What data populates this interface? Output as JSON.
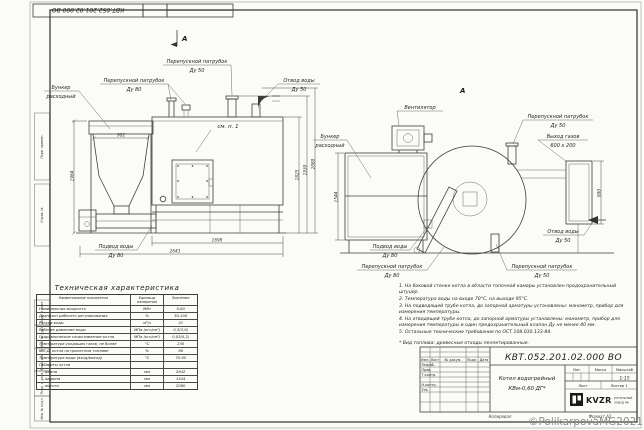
{
  "sheet": {
    "corner_stamp": "КВТ.052.201.02.000  ВО",
    "watermark": "©PolikarpovaMG2021"
  },
  "margin_fields": [
    "Перв. примен.",
    "Справ. №",
    "Подп. и дата",
    "Инв. № дубл.",
    "Взам. инв. №",
    "Подп. и дата",
    "Инв. № подл."
  ],
  "left_view": {
    "section_label": "А",
    "see_note": "см. п. 1",
    "labels": {
      "bunker": [
        "Бункер",
        "расходный"
      ],
      "bypass80": [
        "Перепускной патрубок",
        "Ду 80"
      ],
      "bypass50": [
        "Перепускной патрубок",
        "Ду 50"
      ],
      "outlet50": [
        "Отвод воды",
        "Ду 50"
      ],
      "inlet80": [
        "Подвод воды",
        "Ду 80"
      ]
    },
    "dims": {
      "top": "902",
      "left": "1964",
      "h1": "1825",
      "h2": "1930",
      "h3": "2080",
      "screw": "1698",
      "total": "2643"
    }
  },
  "right_view": {
    "view_label": "А",
    "labels": {
      "fan": "Вентилятор",
      "bunker": [
        "Бункер",
        "расходный"
      ],
      "bypass50_top": [
        "Перепускной патрубок",
        "Ду 50"
      ],
      "gas_out": [
        "Выход газов",
        "600 х 200"
      ],
      "outlet50": [
        "Отвод воды",
        "Ду 50"
      ],
      "inlet80": [
        "Подвод воды",
        "Ду 80"
      ],
      "bypass80": [
        "Перепускной патрубок",
        "Ду 80"
      ],
      "bypass50_bottom": [
        "Перепускной патрубок",
        "Ду 50"
      ]
    },
    "dims": {
      "bunker_h": "1544",
      "gas_h": "600"
    }
  },
  "table": {
    "title": "Техническая характеристика",
    "headers": [
      "Наименование показателя",
      "Единицы измерения",
      "Значение"
    ],
    "rows": [
      [
        "Номинальная мощность",
        "МВт",
        "0,60"
      ],
      [
        "Диапазон рабочего регулирования",
        "%",
        "30-100"
      ],
      [
        "Расход воды",
        "м³/ч",
        "21"
      ],
      [
        "Рабочее давление воды",
        "МПа (кгс/см²)",
        "0,3(3,0)"
      ],
      [
        "Гидравлическое сопротивление котла",
        "МПа (кгс/см²)",
        "0,02(0,2)"
      ],
      [
        "Температура уходящих газов, не более",
        "°С",
        "230"
      ],
      [
        "К.П.Д. котла на проектном топливе",
        "%",
        "80"
      ],
      [
        "Температура воды (вход/выход)",
        "°С",
        "70-95"
      ],
      [
        "Габариты котла",
        "",
        ""
      ],
      [
        "   - длина",
        "мм",
        "2642"
      ],
      [
        "   - ширина",
        "мм",
        "1544"
      ],
      [
        "   - высота",
        "мм",
        "2080"
      ]
    ]
  },
  "notes": {
    "items": [
      "1. На боковой стенке котла в области топочной камеры установлен предохранительный штуцер.",
      "2. Температура воды на входе 70°С, на выходе 95°С.",
      "3. На подводящей трубе котла, до запорной арматуры установлены: манометр, прибор для измерения температуры.",
      "4. На отводящей трубе котла, до запорной арматуры установлены: манометр, прибор для измерения температуры и один предохранительный клапан Ду не менее 40 мм.",
      "5. Остальные технические требования по ОСТ 108.030.133-84."
    ],
    "footnote": "* Вид топлива: древесные отходы пеллетированные."
  },
  "title_block": {
    "doc_number": "КВТ.052.201.02.000  ВО",
    "name_line1": "Котел водогрейный",
    "name_line2": "КВм-0,60  ДГ*",
    "col_headers": [
      "Изм.",
      "Лист",
      "№ докум.",
      "Подп.",
      "Дата"
    ],
    "row_labels": [
      "Разраб.",
      "Пров.",
      "Т.контр.",
      "Н.контр.",
      "Утв."
    ],
    "lit_label": "Лит.",
    "mass_label": "Масса",
    "scale_label": "Масштаб",
    "scale_value": "1:15",
    "sheet_label": "Лист",
    "sheets_label": "Листов 1",
    "logo_text": "KVZR",
    "logo_caption1": "КОТЕЛЬНЫЙ",
    "logo_caption2": "ЗАВОД РФ",
    "copied": "Копировал",
    "format": "Формат А2"
  }
}
